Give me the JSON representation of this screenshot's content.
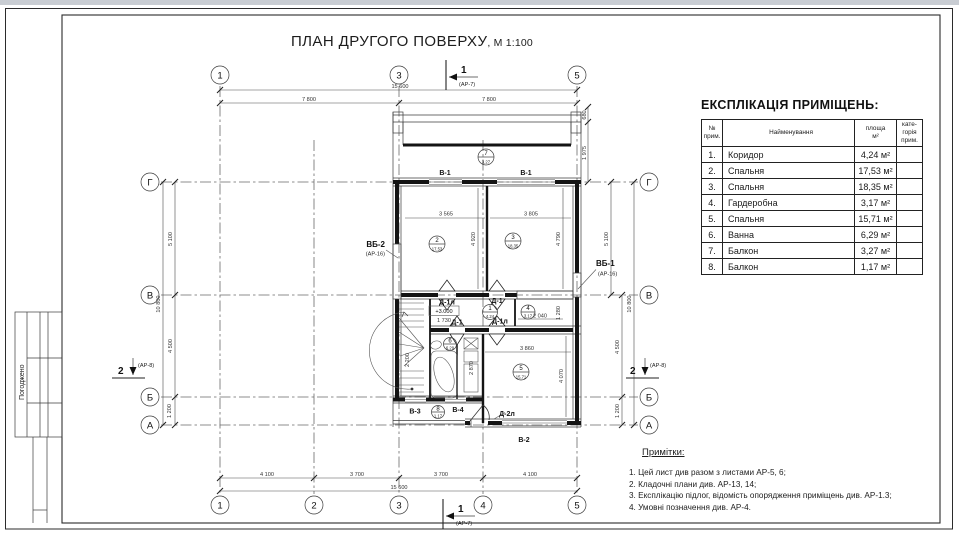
{
  "title": {
    "main": "ПЛАН ДРУГОГО ПОВЕРХУ",
    "scale": ", М 1:100"
  },
  "stamp": {
    "label": "Погоджено"
  },
  "axes": {
    "top": [
      "1",
      "3",
      "5"
    ],
    "bottom": [
      "1",
      "2",
      "3",
      "4",
      "5"
    ],
    "left": [
      "Г",
      "В",
      "Б",
      "А"
    ],
    "right": [
      "Г",
      "В",
      "Б",
      "А"
    ]
  },
  "sections": {
    "s1_num": "1",
    "s1_ref": "(АР-7)",
    "s2_num": "2",
    "s2_ref": "(АР-8)"
  },
  "dims": {
    "w_total": "15 600",
    "w_half_l": "7 800",
    "w_half_r": "7 800",
    "b_1": "4 100",
    "b_2": "3 700",
    "b_3": "3 700",
    "b_4": "4 100",
    "b_total": "15 600",
    "l_total": "10 800",
    "l_g_v": "5 100",
    "l_v_b": "4 500",
    "l_b_a": "1 200",
    "r_680": "680",
    "r_1975": "1 975",
    "r_g_v": "5 100",
    "r_v_b": "4 500",
    "r_b_a": "1 200",
    "r_total": "10 800",
    "room2_w": "3 565",
    "room3_w": "3 805",
    "room2_h": "4 920",
    "room3_h": "4 790",
    "room5_w": "3 860",
    "room5_h": "4 070",
    "bath_h": "2 870",
    "room4_w": "2 040",
    "room4_h": "1 280",
    "corr_w": "1 730",
    "stair_w": "2 200"
  },
  "labels": {
    "vb2": "ВБ-2",
    "vb1": "ВБ-1",
    "ar16a": "(АР-16)",
    "ar16b": "(АР-16)",
    "w1a": "В-1",
    "w1b": "В-1",
    "w2": "В-2",
    "w3": "В-3",
    "w4": "В-4",
    "d1l_top": "Д-1л",
    "d1_top": "Д-1",
    "d1_bot": "Д-1",
    "d1l_bot": "Д-1л",
    "d2l": "Д-2л",
    "elev": "+3.000"
  },
  "rooms": [
    {
      "num": "1",
      "area": "4,24"
    },
    {
      "num": "2",
      "area": "17,53"
    },
    {
      "num": "3",
      "area": "18,35"
    },
    {
      "num": "4",
      "area": "3,17"
    },
    {
      "num": "5",
      "area": "15,71"
    },
    {
      "num": "6",
      "area": "6,29"
    },
    {
      "num": "7",
      "area": "3,27"
    },
    {
      "num": "8",
      "area": "1,17"
    }
  ],
  "explication": {
    "title": "ЕКСПЛІКАЦІЯ ПРИМІЩЕНЬ:",
    "headers": {
      "num": "№\nприм.",
      "name": "Найменування",
      "area": "площа\nм²",
      "cat": "кате-\nгорія\nприм."
    },
    "rows": [
      {
        "num": "1.",
        "name": "Коридор",
        "area": "4,24 м²"
      },
      {
        "num": "2.",
        "name": "Спальня",
        "area": "17,53 м²"
      },
      {
        "num": "3.",
        "name": "Спальня",
        "area": "18,35 м²"
      },
      {
        "num": "4.",
        "name": "Гардеробна",
        "area": "3,17 м²"
      },
      {
        "num": "5.",
        "name": "Спальня",
        "area": "15,71 м²"
      },
      {
        "num": "6.",
        "name": "Ванна",
        "area": "6,29 м²"
      },
      {
        "num": "7.",
        "name": "Балкон",
        "area": "3,27 м²"
      },
      {
        "num": "8.",
        "name": "Балкон",
        "area": "1,17 м²"
      }
    ]
  },
  "notes": {
    "title": "Примітки:",
    "items": [
      "1. Цей лист див разом з листами АР-5, 6;",
      "2. Кладочні плани див. АР-13, 14;",
      "3. Експлікацію підлог, відомість опорядження приміщень див. АР-1.3;",
      "4. Умовні позначення див. АР-4."
    ]
  },
  "colors": {
    "paper": "#ffffff",
    "line": "#141414",
    "dim": "#4a4a4a"
  }
}
